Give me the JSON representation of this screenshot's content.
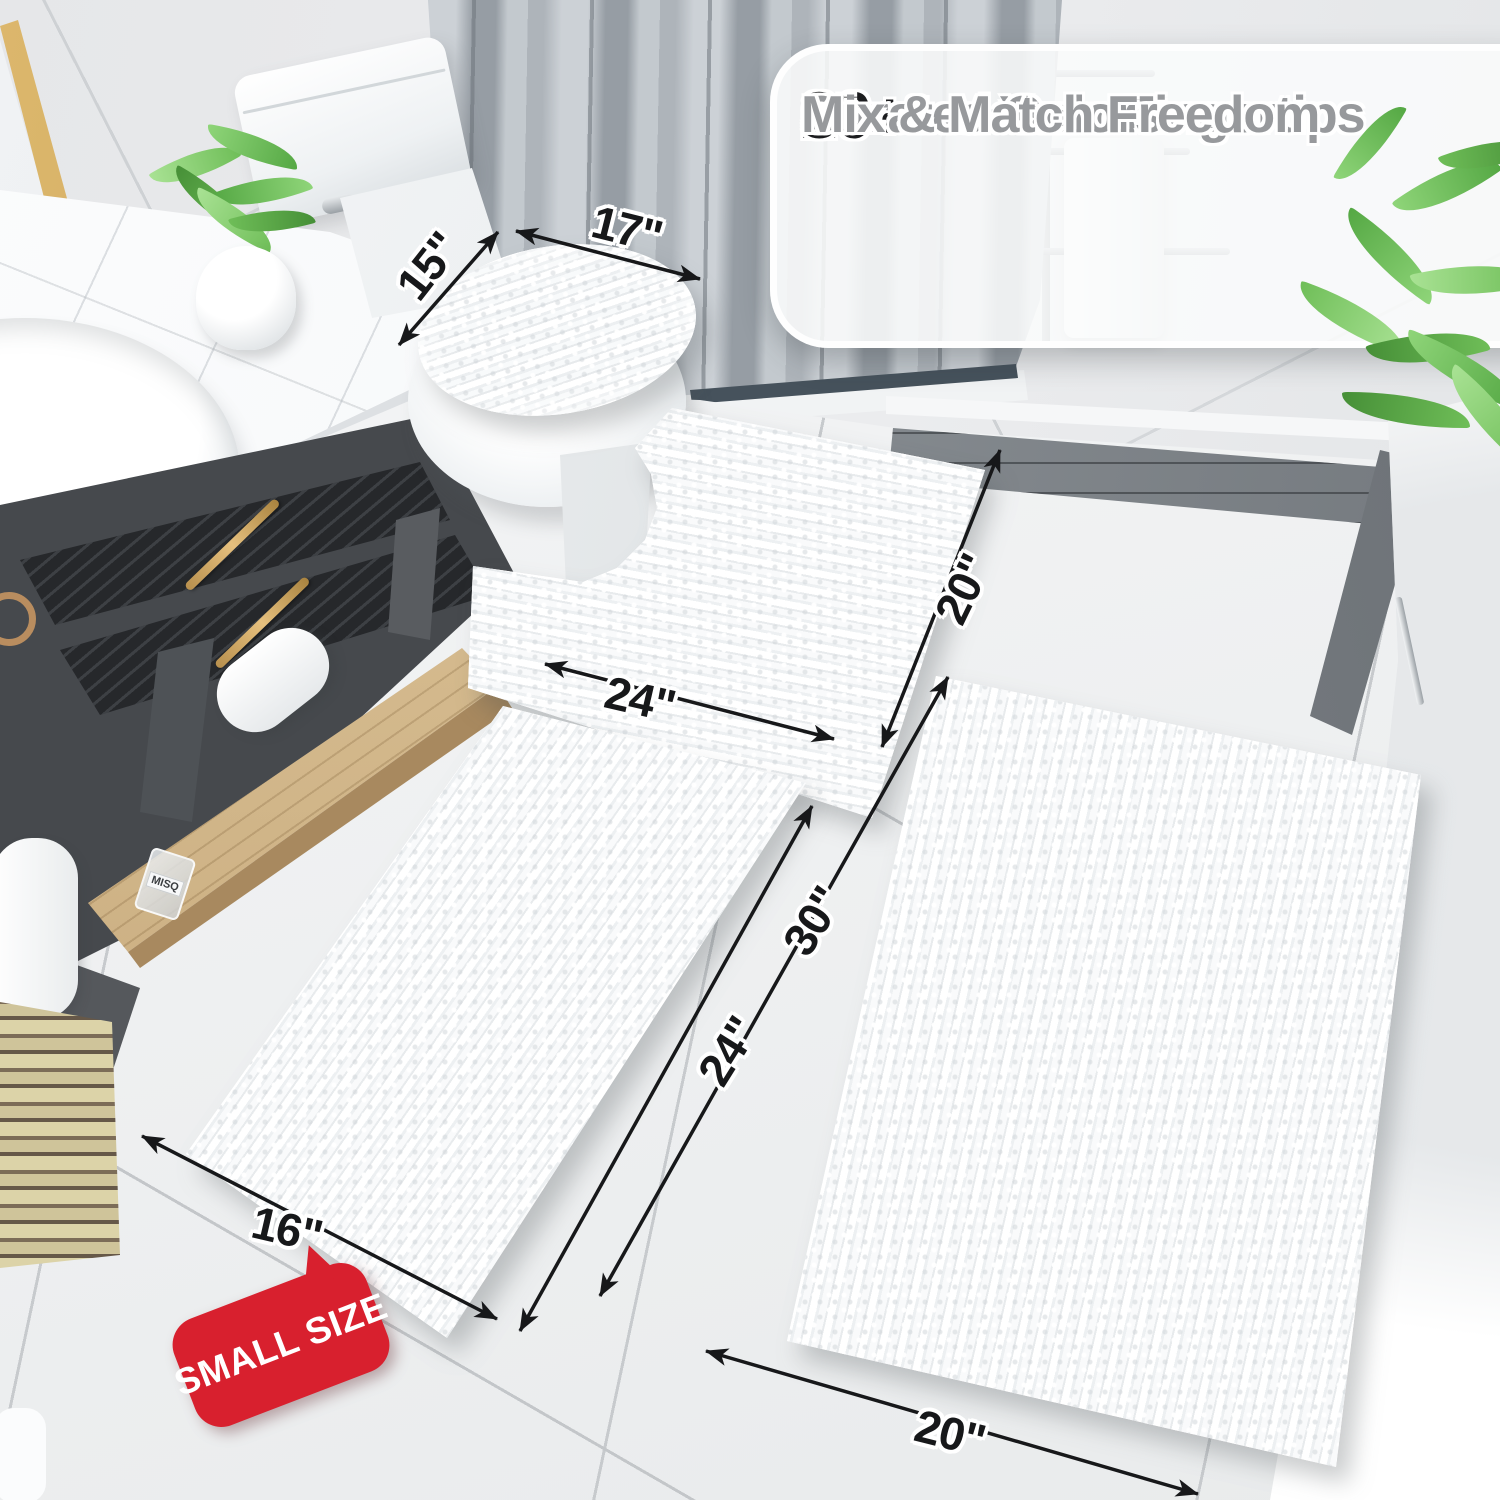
{
  "callout": {
    "items": [
      {
        "check": "✓",
        "stat": "20+",
        "label": "Sizes at Your Fingertips"
      },
      {
        "check": "✓",
        "stat": "30+",
        "label": "Curated Colors"
      },
      {
        "check": "✓",
        "stat": "",
        "label": "Mix & Match Freedom"
      }
    ]
  },
  "dimensions": {
    "lid": {
      "width": "15\"",
      "length": "17\""
    },
    "contour": {
      "width": "24\"",
      "depth": "20\""
    },
    "small": {
      "width": "16\"",
      "length": "24\""
    },
    "large": {
      "length": "30\"",
      "width": "20\""
    }
  },
  "badge": {
    "label": "SMALL SIZE"
  },
  "decor": {
    "bottle_label": "MISQ"
  },
  "colors": {
    "badge_red": "#d8202e",
    "stat_text": "#1c1d1f",
    "feature_text": "#97999c",
    "check_gray": "#8d9093",
    "gold": "#c79a58",
    "leaf_green": "#6fbe58",
    "charcoal": "#46494d"
  }
}
